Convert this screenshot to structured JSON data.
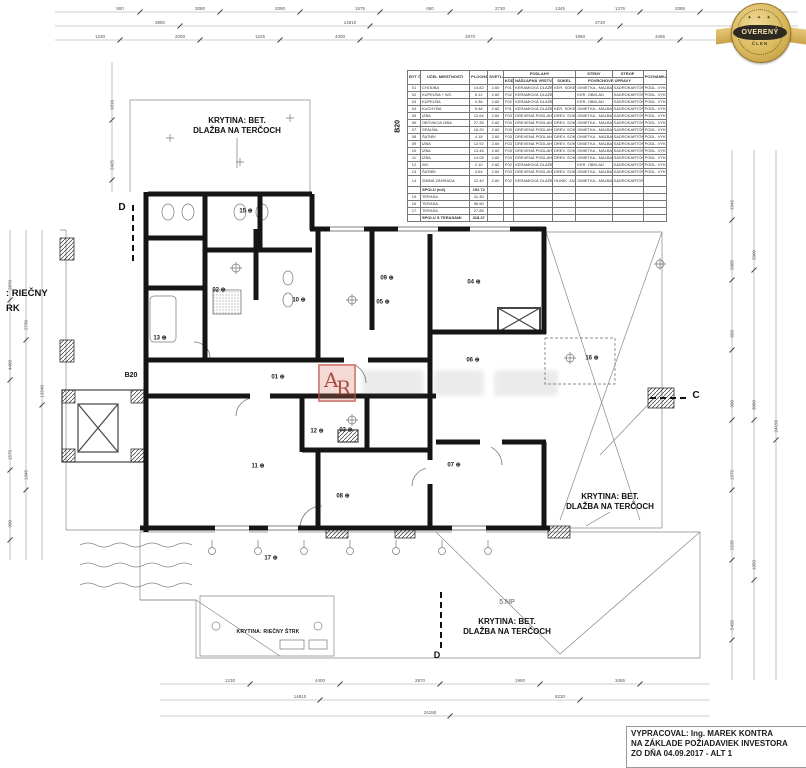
{
  "badge": {
    "line1": "OVERENÝ",
    "line2": "ČLEN",
    "stars": "✦ ✦ ✦",
    "gold": "#d9b95c",
    "dark": "#2e2a22"
  },
  "watermark": {
    "logo_a": "A",
    "logo_r": "R",
    "accent": "#c0392b"
  },
  "title_block": {
    "line1": "VYPRACOVAL: Ing. MAREK KONTRA",
    "line2": "NA ZÁKLADE POŽIADAVIEK INVESTORA",
    "line3": "ZO DŇA 04.09.2017 - ALT 1"
  },
  "plan": {
    "labels": [
      {
        "t": "KRYTINA: BET.\nDLAŽBA NA TERČOCH",
        "x": 237,
        "y": 116,
        "cls": "note",
        "nm": "roof-covering-label-top"
      },
      {
        "t": "KRYTINA: BET.\nDLAŽBA NA TERČOCH",
        "x": 610,
        "y": 492,
        "cls": "note",
        "nm": "roof-covering-label-right"
      },
      {
        "t": "KRYTINA: BET.\nDLAŽBA NA TERČOCH",
        "x": 507,
        "y": 617,
        "cls": "note",
        "nm": "roof-covering-label-bottom"
      },
      {
        "t": "5.NP",
        "x": 507,
        "y": 599,
        "cls": "np",
        "nm": "floor-level-label"
      },
      {
        "t": "KRYTINA: RIEČNY ŠTRK",
        "x": 268,
        "y": 629,
        "cls": "note-sm",
        "nm": "gravel-covering-label"
      },
      {
        "t": ": RIEČNY",
        "x": 6,
        "y": 288,
        "cls": "left1",
        "nm": "edge-covering-label-1"
      },
      {
        "t": "RK",
        "x": 6,
        "y": 303,
        "cls": "left1",
        "nm": "edge-covering-label-2"
      },
      {
        "t": "D",
        "x": 122,
        "y": 202,
        "cls": "sec",
        "nm": "section-mark-d"
      },
      {
        "t": "C",
        "x": 696,
        "y": 390,
        "cls": "sec",
        "nm": "section-mark-c"
      },
      {
        "t": "D",
        "x": 437,
        "y": 650,
        "cls": "sec2",
        "nm": "section-mark-d-bottom"
      },
      {
        "t": "B20",
        "x": 131,
        "y": 372,
        "cls": "b20",
        "nm": "apartment-id-label"
      },
      {
        "t": "B20",
        "x": 399,
        "y": 122,
        "cls": "b20v",
        "nm": "apartment-id-label-table"
      }
    ],
    "rooms": [
      {
        "n": "15",
        "x": 246,
        "y": 211
      },
      {
        "n": "02",
        "x": 219,
        "y": 290
      },
      {
        "n": "13",
        "x": 160,
        "y": 338
      },
      {
        "n": "10",
        "x": 299,
        "y": 300
      },
      {
        "n": "09",
        "x": 387,
        "y": 278
      },
      {
        "n": "05",
        "x": 383,
        "y": 302
      },
      {
        "n": "04",
        "x": 474,
        "y": 282
      },
      {
        "n": "06",
        "x": 473,
        "y": 360
      },
      {
        "n": "16",
        "x": 592,
        "y": 358
      },
      {
        "n": "01",
        "x": 278,
        "y": 377
      },
      {
        "n": "12",
        "x": 317,
        "y": 431
      },
      {
        "n": "03",
        "x": 346,
        "y": 430
      },
      {
        "n": "11",
        "x": 258,
        "y": 466
      },
      {
        "n": "08",
        "x": 343,
        "y": 496
      },
      {
        "n": "07",
        "x": 454,
        "y": 465
      },
      {
        "n": "17",
        "x": 271,
        "y": 558
      }
    ]
  },
  "dims": {
    "h": [
      {
        "t": "900",
        "x": 120,
        "y": 11
      },
      {
        "t": "3080",
        "x": 200,
        "y": 11
      },
      {
        "t": "2090",
        "x": 280,
        "y": 11
      },
      {
        "t": "1575",
        "x": 360,
        "y": 11
      },
      {
        "t": "650",
        "x": 430,
        "y": 11
      },
      {
        "t": "2730",
        "x": 500,
        "y": 11
      },
      {
        "t": "1345",
        "x": 560,
        "y": 11
      },
      {
        "t": "1375",
        "x": 620,
        "y": 11
      },
      {
        "t": "2085",
        "x": 680,
        "y": 11
      },
      {
        "t": "2235",
        "x": 758,
        "y": 11
      },
      {
        "t": "3980",
        "x": 160,
        "y": 25
      },
      {
        "t": "14810",
        "x": 350,
        "y": 25
      },
      {
        "t": "2730",
        "x": 600,
        "y": 25
      },
      {
        "t": "8230",
        "x": 742,
        "y": 25
      },
      {
        "t": "1230",
        "x": 100,
        "y": 39
      },
      {
        "t": "2000",
        "x": 180,
        "y": 39
      },
      {
        "t": "1225",
        "x": 260,
        "y": 39
      },
      {
        "t": "4400",
        "x": 340,
        "y": 39
      },
      {
        "t": "2870",
        "x": 470,
        "y": 39
      },
      {
        "t": "1950",
        "x": 580,
        "y": 39
      },
      {
        "t": "3465",
        "x": 660,
        "y": 39
      },
      {
        "t": "2115",
        "x": 742,
        "y": 39
      },
      {
        "t": "1230",
        "x": 230,
        "y": 683
      },
      {
        "t": "4400",
        "x": 320,
        "y": 683
      },
      {
        "t": "2870",
        "x": 420,
        "y": 683
      },
      {
        "t": "1950",
        "x": 520,
        "y": 683
      },
      {
        "t": "3465",
        "x": 620,
        "y": 683
      },
      {
        "t": "14810",
        "x": 300,
        "y": 699
      },
      {
        "t": "8230",
        "x": 560,
        "y": 699
      },
      {
        "t": "24150",
        "x": 430,
        "y": 715
      }
    ],
    "v": [
      {
        "t": "2870",
        "x": 10,
        "y": 280
      },
      {
        "t": "4400",
        "x": 10,
        "y": 360
      },
      {
        "t": "1575",
        "x": 10,
        "y": 450
      },
      {
        "t": "900",
        "x": 10,
        "y": 520
      },
      {
        "t": "2730",
        "x": 26,
        "y": 320
      },
      {
        "t": "1345",
        "x": 26,
        "y": 470
      },
      {
        "t": "13240",
        "x": 42,
        "y": 385
      },
      {
        "t": "1810",
        "x": 112,
        "y": 100
      },
      {
        "t": "2425",
        "x": 112,
        "y": 160
      },
      {
        "t": "1345",
        "x": 732,
        "y": 200
      },
      {
        "t": "2085",
        "x": 732,
        "y": 260
      },
      {
        "t": "650",
        "x": 732,
        "y": 330
      },
      {
        "t": "900",
        "x": 732,
        "y": 400
      },
      {
        "t": "1375",
        "x": 732,
        "y": 470
      },
      {
        "t": "2235",
        "x": 732,
        "y": 540
      },
      {
        "t": "5495",
        "x": 732,
        "y": 620
      },
      {
        "t": "2000",
        "x": 754,
        "y": 250
      },
      {
        "t": "3080",
        "x": 754,
        "y": 400
      },
      {
        "t": "1950",
        "x": 754,
        "y": 560
      },
      {
        "t": "24150",
        "x": 776,
        "y": 420
      }
    ]
  },
  "table": {
    "h": {
      "cm": "BYT Č. Č.M",
      "ucel": "ÚČEL MIESTNOSTI",
      "plocha": "PLOCHA (m2)",
      "vyska": "SVETLÁ VÝŠKA (m)",
      "podlahy": "PODLAHY",
      "kod": "KÓD",
      "naslapna": "NÁŠĽAPNÁ VRSTVA",
      "sokel": "SOKEL",
      "steny": "STENY",
      "strop": "STROP",
      "povrch": "POVRCHOVÉ ÚPRAVY",
      "pozn": "POZNÁMKA"
    },
    "rows": [
      {
        "t": "n",
        "c": [
          "01",
          "CHODBA",
          "14.82",
          "2.60",
          "F01",
          "KERAMICKÁ DLAŽBA",
          "KER. SOKEL",
          "OMIETKA - MAĽBA",
          "SADROKARTÓN",
          "PODL. VYKUR."
        ]
      },
      {
        "t": "n",
        "c": [
          "02",
          "KÚPEĽŇA + WC",
          "5.12",
          "2.60",
          "F02",
          "KERAMICKÁ DLAŽBA",
          "",
          "KER. OBKLAD",
          "SADROKARTÓN",
          "PODL. VYKUR."
        ]
      },
      {
        "t": "n",
        "c": [
          "03",
          "KÚPEĽŇA",
          "4.36",
          "2.60",
          "F02",
          "KERAMICKÁ DLAŽBA",
          "",
          "KER. OBKLAD",
          "SADROKARTÓN",
          "PODL. VYKUR."
        ]
      },
      {
        "t": "n",
        "c": [
          "04",
          "KUCHYŇA",
          "9.48",
          "2.60",
          "F01",
          "KERAMICKÁ DLAŽBA",
          "KER. SOKEL",
          "OMIETKA - MAĽBA",
          "SADROKARTÓN",
          "PODL. VYKUR."
        ]
      },
      {
        "t": "n",
        "c": [
          "05",
          "IZBA",
          "12.64",
          "2.60",
          "F03",
          "DREVENÁ PODLAHA",
          "DREV. SOKEL",
          "OMIETKA - MAĽBA",
          "SADROKARTÓN",
          "PODL. VYKUR."
        ]
      },
      {
        "t": "n",
        "c": [
          "06",
          "OBÝVACIA IZBA",
          "27.35",
          "2.60",
          "F03",
          "DREVENÁ PODLAHA",
          "DREV. SOKEL",
          "OMIETKA - MAĽBA",
          "SADROKARTÓN",
          "PODL. VYKUR."
        ]
      },
      {
        "t": "n",
        "c": [
          "07",
          "SPÁLŇA",
          "16.20",
          "2.60",
          "F03",
          "DREVENÁ PODLAHA",
          "DREV. SOKEL",
          "OMIETKA - MAĽBA",
          "SADROKARTÓN",
          "PODL. VYKUR."
        ]
      },
      {
        "t": "n",
        "c": [
          "08",
          "ŠATNÍK",
          "4.18",
          "2.60",
          "F03",
          "DREVENÁ PODLAHA",
          "DREV. SOKEL",
          "OMIETKA - MAĽBA",
          "SADROKARTÓN",
          "PODL. VYKUR."
        ]
      },
      {
        "t": "n",
        "c": [
          "09",
          "IZBA",
          "12.92",
          "2.60",
          "F03",
          "DREVENÁ PODLAHA",
          "DREV. SOKEL",
          "OMIETKA - MAĽBA",
          "SADROKARTÓN",
          "PODL. VYKUR."
        ]
      },
      {
        "t": "n",
        "c": [
          "10",
          "IZBA",
          "13.46",
          "2.60",
          "F03",
          "DREVENÁ PODLAHA",
          "DREV. SOKEL",
          "OMIETKA - MAĽBA",
          "SADROKARTÓN",
          "PODL. VYKUR."
        ]
      },
      {
        "t": "n",
        "c": [
          "11",
          "IZBA",
          "14.05",
          "2.60",
          "F03",
          "DREVENÁ PODLAHA",
          "DREV. SOKEL",
          "OMIETKA - MAĽBA",
          "SADROKARTÓN",
          "PODL. VYKUR."
        ]
      },
      {
        "t": "n",
        "c": [
          "12",
          "WC",
          "2.10",
          "2.60",
          "F02",
          "KERAMICKÁ DLAŽBA",
          "",
          "KER. OBKLAD",
          "SADROKARTÓN",
          "PODL. VYKUR."
        ]
      },
      {
        "t": "n",
        "c": [
          "13",
          "ŠATNÍK",
          "3.64",
          "2.60",
          "F03",
          "DREVENÁ PODLAHA",
          "DREV. SOKEL",
          "OMIETKA - MAĽBA",
          "SADROKARTÓN",
          "PODL. VYKUR."
        ]
      },
      {
        "t": "tall",
        "c": [
          "14",
          "ZIMNÁ ZÁHRADA",
          "12.40",
          "2.60",
          "F02",
          "KERAMICKÁ DLAŽBA",
          "HLINÍK. ZASKLENIE",
          "OMIETKA - MAĽBA",
          "SADROKARTÓN",
          ""
        ]
      },
      {
        "t": "sum",
        "c": [
          "",
          "SPOLU (m2)",
          "152.72",
          "",
          "",
          "",
          "",
          "",
          "",
          ""
        ]
      },
      {
        "t": "n",
        "c": [
          "15",
          "TERASA",
          "41.30",
          "",
          "",
          "",
          "",
          "",
          "",
          ""
        ]
      },
      {
        "t": "n",
        "c": [
          "16",
          "TERASA",
          "96.50",
          "",
          "",
          "",
          "",
          "",
          "",
          ""
        ]
      },
      {
        "t": "n",
        "c": [
          "17",
          "TERASA",
          "27.85",
          "",
          "",
          "",
          "",
          "",
          "",
          ""
        ]
      },
      {
        "t": "sum",
        "c": [
          "",
          "SPOLU S TERASAMI",
          "318.37",
          "",
          "",
          "",
          "",
          "",
          "",
          ""
        ]
      }
    ]
  }
}
